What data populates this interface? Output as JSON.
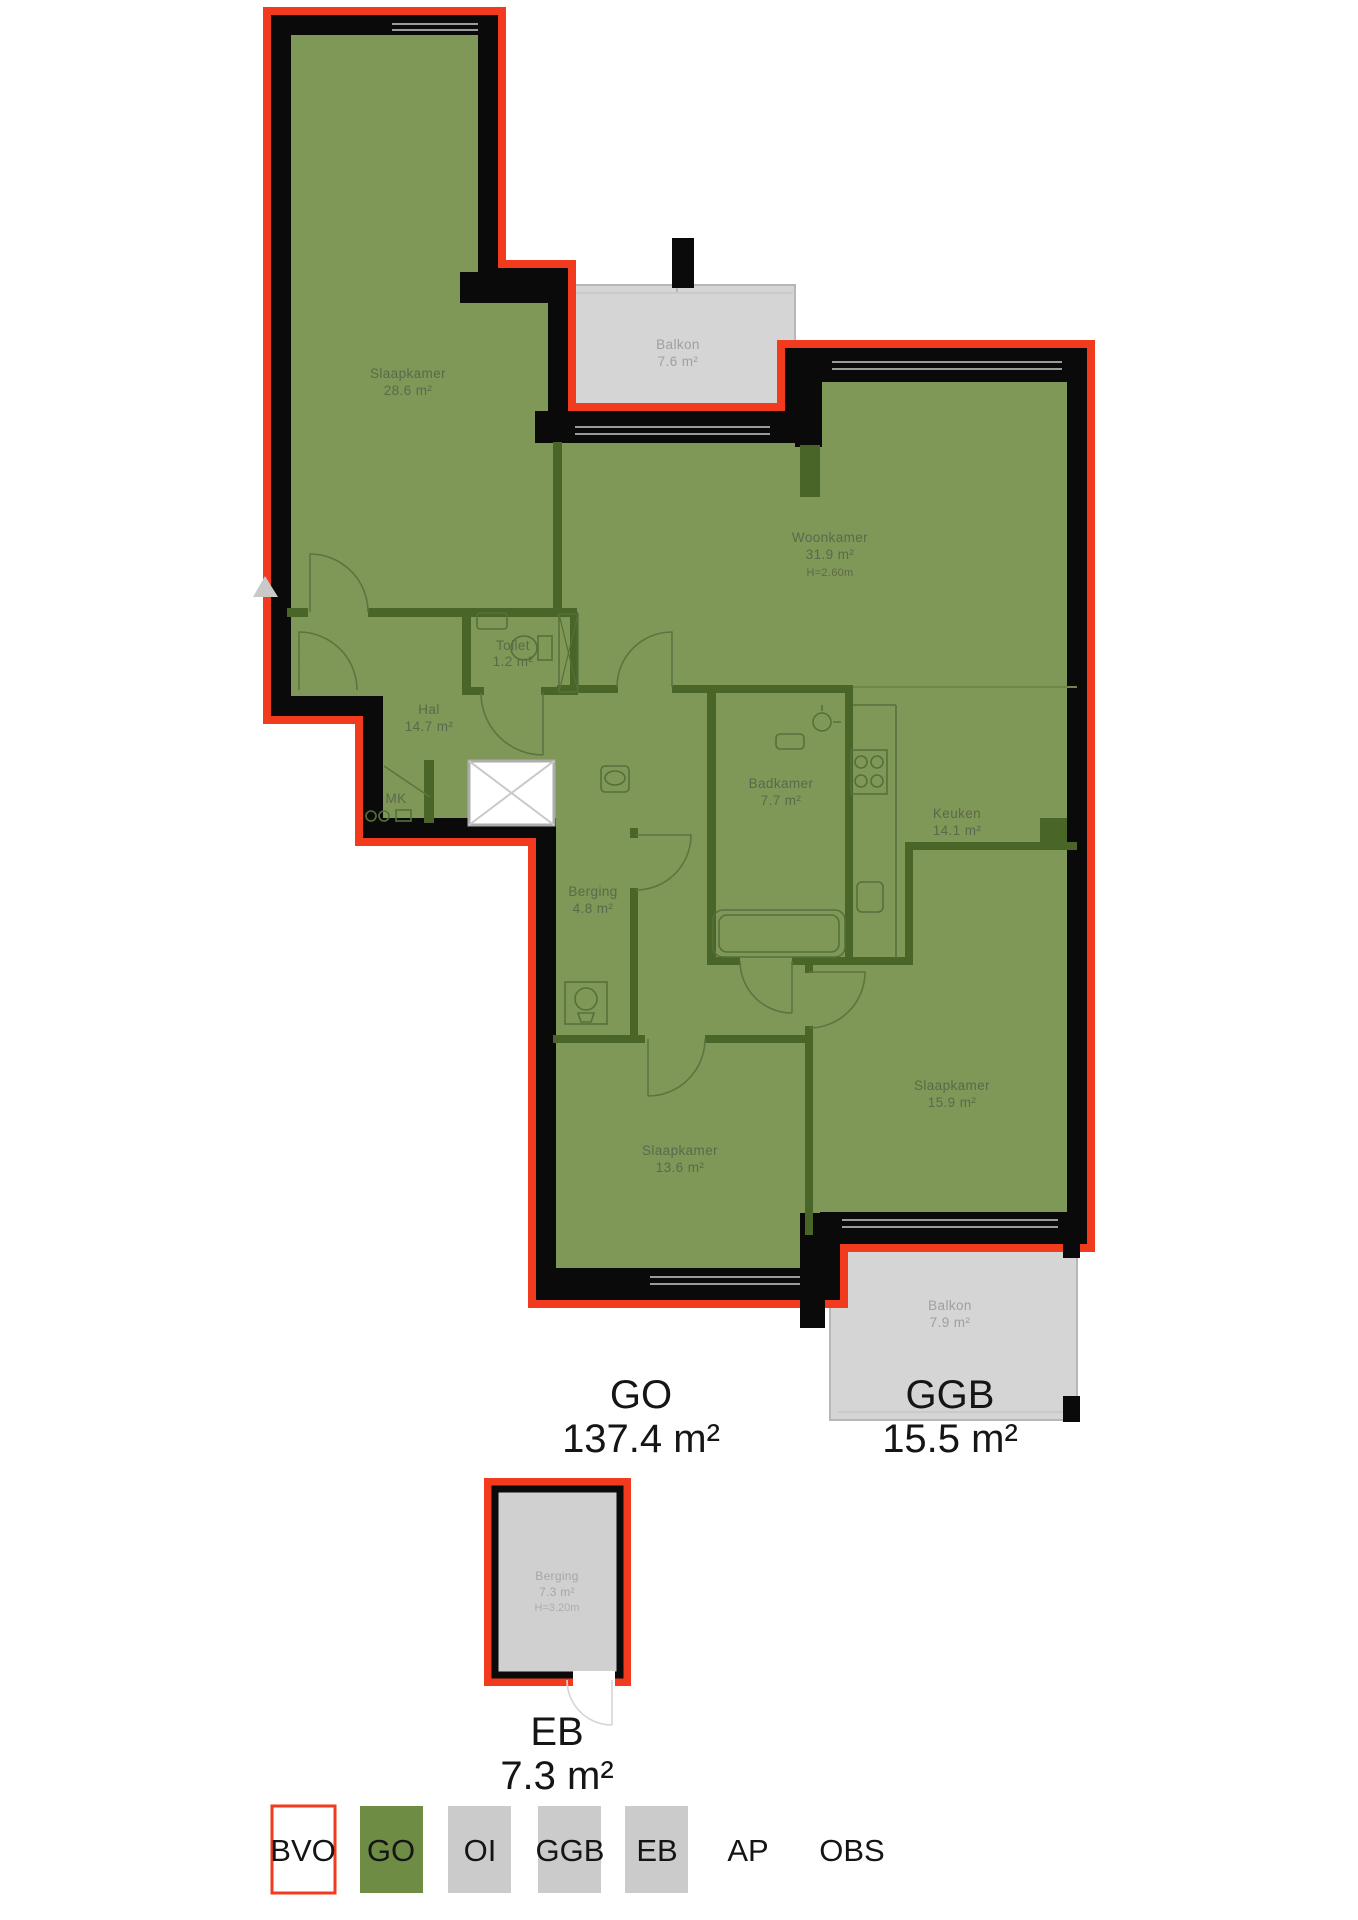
{
  "floorplan": {
    "rooms": {
      "slaapkamer1": {
        "name": "Slaapkamer",
        "area": "28.6 m²"
      },
      "balkon1": {
        "name": "Balkon",
        "area": "7.6 m²"
      },
      "woonkamer": {
        "name": "Woonkamer",
        "area": "31.9 m²",
        "height": "H=2.60m"
      },
      "toilet": {
        "name": "Toilet",
        "area": "1.2 m²"
      },
      "hal": {
        "name": "Hal",
        "area": "14.7 m²"
      },
      "mk": {
        "name": "MK"
      },
      "badkamer": {
        "name": "Badkamer",
        "area": "7.7 m²"
      },
      "keuken": {
        "name": "Keuken",
        "area": "14.1 m²"
      },
      "berging": {
        "name": "Berging",
        "area": "4.8 m²"
      },
      "slaapkamer2": {
        "name": "Slaapkamer",
        "area": "13.6 m²"
      },
      "slaapkamer3": {
        "name": "Slaapkamer",
        "area": "15.9 m²"
      },
      "balkon2": {
        "name": "Balkon",
        "area": "7.9 m²"
      },
      "berging_eb": {
        "name": "Berging",
        "area": "7.3 m²",
        "height": "H=3.20m"
      }
    },
    "summary": {
      "go": {
        "label": "GO",
        "value": "137.4 m²"
      },
      "ggb": {
        "label": "GGB",
        "value": "15.5 m²"
      },
      "eb": {
        "label": "EB",
        "value": "7.3 m²"
      }
    },
    "legend": {
      "items": [
        {
          "label": "BVO",
          "style": "outline"
        },
        {
          "label": "GO",
          "style": "green"
        },
        {
          "label": "OI",
          "style": "gray"
        },
        {
          "label": "GGB",
          "style": "gray"
        },
        {
          "label": "EB",
          "style": "gray"
        },
        {
          "label": "AP",
          "style": "none"
        },
        {
          "label": "OBS",
          "style": "none"
        }
      ]
    },
    "colors": {
      "bvo_outline": "#f23a1e",
      "go_fill": "#7f9858",
      "interior_wall": "#4a6528",
      "wall": "#0a0a0a",
      "ggb_fill": "#d5d5d5",
      "eb_fill": "#d0d0d0",
      "legend_green": "#6f8c44",
      "legend_gray": "#cbcbcb"
    }
  }
}
